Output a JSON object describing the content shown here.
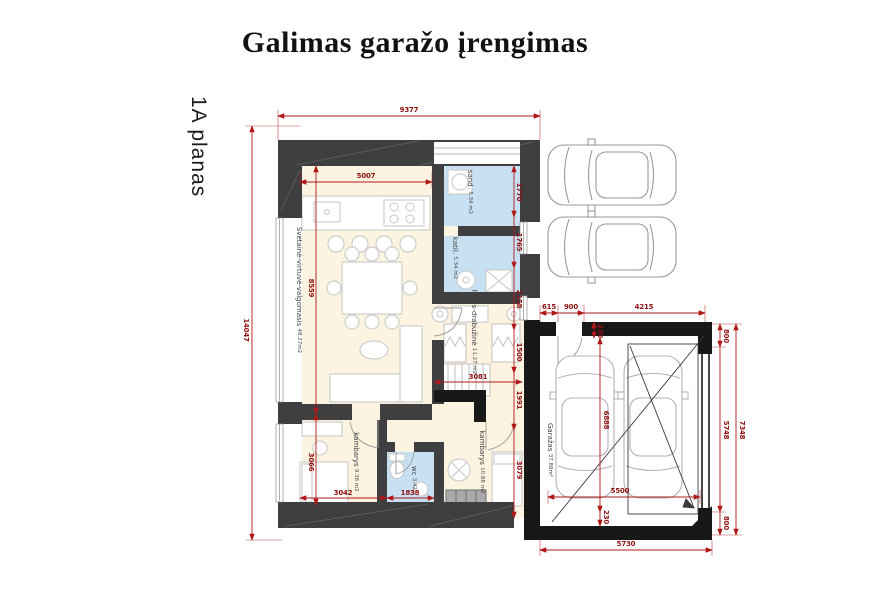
{
  "page": {
    "title": "Galimas garažo įrengimas",
    "plan_label": "1A planas"
  },
  "rooms": {
    "living": {
      "name": "Svetainė-virtuvė-valgomasis",
      "area": "48.27m2"
    },
    "storage": {
      "name": "sand.",
      "area": "5.34 m2"
    },
    "boiler": {
      "name": "katil.",
      "area": "5.34 m2"
    },
    "hall": {
      "name": "holas-drabužinė",
      "area": "11.27 m2"
    },
    "room1": {
      "name": "kambarys",
      "area": "9.36 m2"
    },
    "wc": {
      "name": "wc",
      "area": "3.42"
    },
    "room2": {
      "name": "kambarys",
      "area": "10.88 m2"
    },
    "garage": {
      "name": "Garažas",
      "area": "37.88m²"
    }
  },
  "dims": {
    "overall_width": "9377",
    "overall_height": "14047",
    "kitchen_width": "5007",
    "living_height": "8559",
    "room1_height": "3066",
    "room1_width": "3042",
    "wc_width": "1838",
    "hall_width": "3081",
    "right_1770": "1770",
    "right_1765": "1765",
    "right_2158": "2158",
    "right_1500": "1500",
    "right_1991": "1991",
    "right_3079": "3079",
    "garage_615": "615",
    "garage_900": "900",
    "garage_4215": "4215",
    "garage_230_top": "230",
    "garage_800_top": "800",
    "garage_5748": "5748",
    "garage_800_bottom": "800",
    "garage_7348": "7348",
    "garage_5500": "5500",
    "garage_6888": "6888",
    "garage_230_bottom": "230",
    "garage_5730": "5730"
  },
  "colors": {
    "dimension_red": "#8e1111",
    "wall_dark_gray": "#3f3f42",
    "wall_black": "#181818",
    "room_cream": "#fcf3e1",
    "room_blue": "#c8e1f2"
  }
}
